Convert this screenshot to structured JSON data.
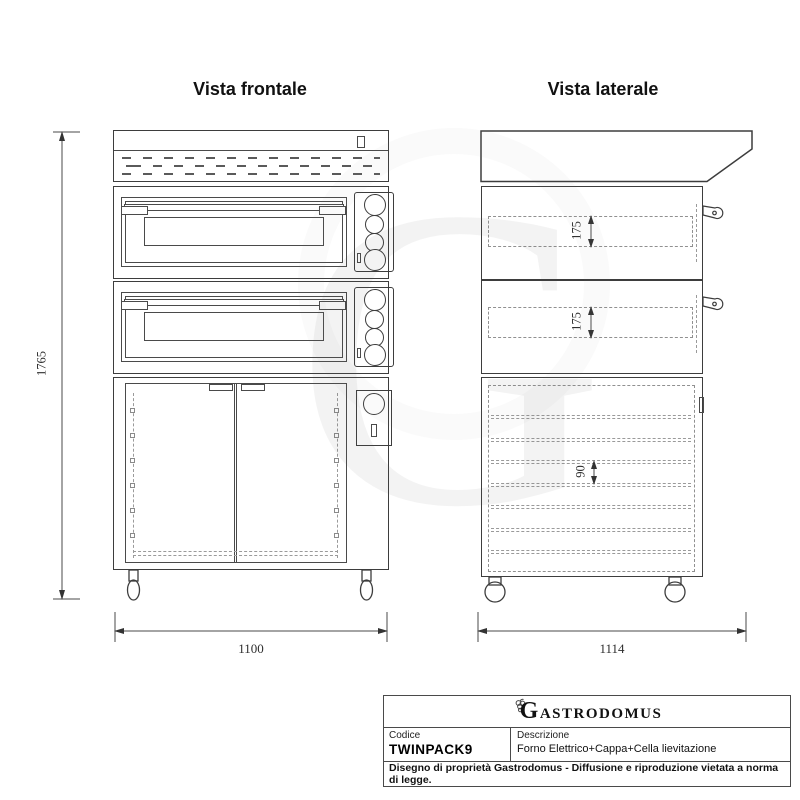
{
  "page": {
    "colors": {
      "line": "#3d3d3d",
      "dashed": "#909090",
      "text": "#1a1a1a"
    }
  },
  "views": {
    "front": {
      "title": "Vista frontale"
    },
    "side": {
      "title": "Vista laterale"
    }
  },
  "dimensions": {
    "overall_height": "1765",
    "front_width": "1100",
    "side_depth": "1114",
    "oven1_chamber_height": "175",
    "oven2_chamber_height": "175",
    "shelf_spacing": "90"
  },
  "watermark": {
    "letter": "G"
  },
  "icons": {
    "logo_icon": "grape-cluster-icon"
  },
  "title_block": {
    "brand": "GASTRODOMUS",
    "code_label": "Codice",
    "code_value": "TWINPACK9",
    "description_label": "Descrizione",
    "description_value": "Forno Elettrico+Cappa+Cella lievitazione",
    "legal_notice": "Disegno di proprietà Gastrodomus - Diffusione e riproduzione vietata a norma di legge."
  }
}
